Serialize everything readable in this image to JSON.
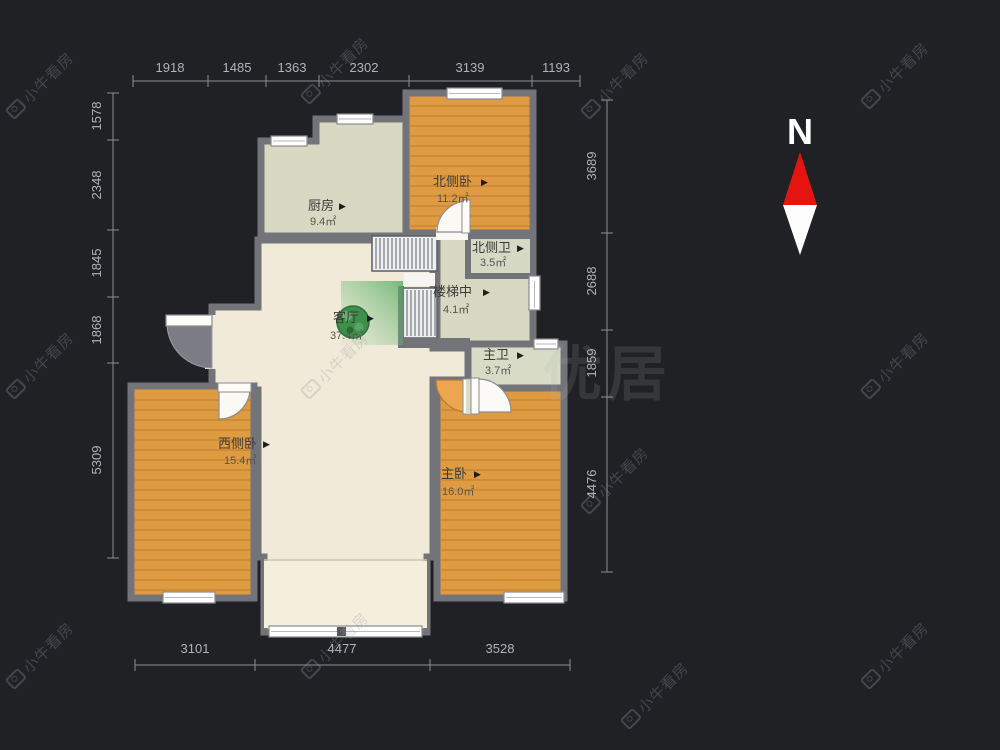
{
  "watermark": {
    "text": "小牛看房",
    "big_text": "优居"
  },
  "compass": {
    "label": "N"
  },
  "ui": {
    "arrow": "▶"
  },
  "rooms": [
    {
      "id": "kitchen",
      "name": "厨房",
      "area": "9.4㎡"
    },
    {
      "id": "north-bedroom",
      "name": "北侧卧",
      "area": "11.2㎡"
    },
    {
      "id": "north-bath",
      "name": "北侧卫",
      "area": "3.5㎡"
    },
    {
      "id": "stairwell",
      "name": "楼梯中",
      "area": "4.1㎡"
    },
    {
      "id": "master-bath",
      "name": "主卫",
      "area": "3.7㎡"
    },
    {
      "id": "living-room",
      "name": "客厅",
      "area": "37.4㎡"
    },
    {
      "id": "west-bedroom",
      "name": "西侧卧",
      "area": "15.4㎡"
    },
    {
      "id": "master-bedroom",
      "name": "主卧",
      "area": "16.0㎡"
    }
  ],
  "dimensions": {
    "top": [
      "1918",
      "1485",
      "1363",
      "2302",
      "3139",
      "1193"
    ],
    "left": [
      "1578",
      "2348",
      "1845",
      "1868",
      "5309"
    ],
    "right": [
      "3689",
      "2688",
      "1859",
      "4476"
    ],
    "bottom": [
      "3101",
      "4477",
      "3528"
    ]
  },
  "colors": {
    "background": "#202125",
    "wall": "#73737a",
    "wood_floor": "#df9b41",
    "tile_floor": "#d8d9c3",
    "living_floor": "#f1ead9",
    "compass_red": "#e41511",
    "dimension_text": "#b2b3b9"
  }
}
